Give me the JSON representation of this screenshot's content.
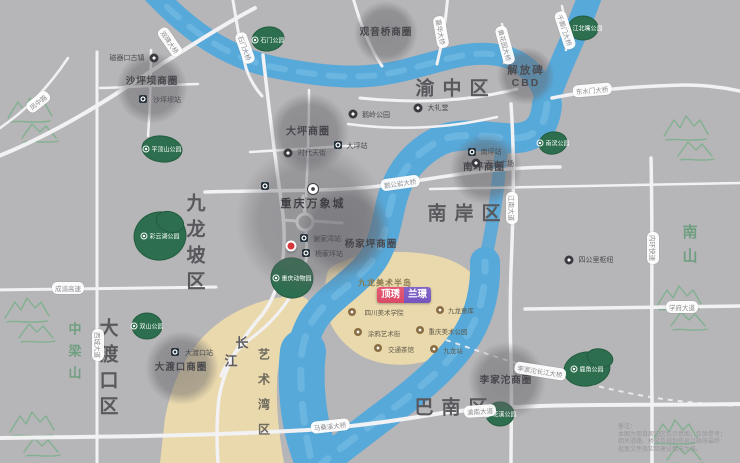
{
  "districts": {
    "yuzhong": "渝中区",
    "nanan": "南岸区",
    "banan": "巴南区",
    "jiulongpo": "九龙坡区",
    "dadukou": "大渡口区"
  },
  "mountains": {
    "zhongliangshan": "中梁山",
    "nanshan": "南山"
  },
  "river": {
    "changjiang_1": "长",
    "changjiang_2": "江",
    "art_bay": "艺术湾区",
    "peninsula": "九龙美术半岛"
  },
  "project": {
    "name_left": "顶琇",
    "name_right": "兰璟"
  },
  "business_circles": {
    "shapingba": "沙坪坝商圈",
    "guanyinqiao": "观音桥商圈",
    "daping": "大坪商圈",
    "jiefangbei_line1": "解放碑",
    "jiefangbei_line2": "CBD",
    "nanping": "南坪商圈",
    "yangjiaping": "杨家坪商圈",
    "dadukou": "大渡口商圈",
    "lijiatuo": "李家沱商圈"
  },
  "landmarks": {
    "mixc": "重庆万象城",
    "ciqikou": "磁器口古镇",
    "eling": "鹅岭公园",
    "dalitang": "大礼堂",
    "sigongli": "四公里枢纽",
    "scfai": "四川美术学院",
    "jiulongyiku": "九龙意库",
    "tuya": "涂鸦艺术街",
    "art_park": "重庆美术公园",
    "tea": "交通茶馆",
    "jiulong_station": "九龙站",
    "times": "时代天街",
    "wanda": "万达广场"
  },
  "metro": {
    "shapingba": "沙坪坝站",
    "daping": "大坪站",
    "nanping": "南坪站",
    "dadukou": "大渡口站",
    "xiejiawan": "谢家湾站",
    "yangjiaping": "杨家坪站"
  },
  "parks": {
    "shimen": "石门公园",
    "pingdingshan": "平顶山公园",
    "caiyunhu": "彩云湖公园",
    "shuangshan": "双山公园",
    "zoo": "重庆动物园",
    "jiangbeizui": "江北嘴公园",
    "nanbin": "南滨公园",
    "huaxi": "花溪公园",
    "lujiao": "鹿角公园"
  },
  "bridges": {
    "shuangbei": "双碑大桥",
    "shimen": "石门大桥",
    "jiahua": "嘉华大桥",
    "huanghuayuan": "黄花园大桥",
    "qiansimen": "千厮门大桥",
    "dongshuimen": "东水门大桥",
    "egongyan": "鹅公岩大桥",
    "masangxi": "马桑溪大桥",
    "lijiatuo": "李家沱长江大桥"
  },
  "roads": {
    "chengyu": "成渝高速",
    "fengzhong": "凤中路",
    "xicheng": "西城大道",
    "neihuan": "内环快速",
    "jiangnan": "江南大道",
    "yunan": "渝南大道",
    "xuefu": "学府大道"
  },
  "colors": {
    "land": "#b6b5b7",
    "river": "#57a9da",
    "river_light": "#7fc2e8",
    "sand": "#ead9ad",
    "park": "#2c6e4d",
    "road": "#f2f1f3",
    "project_left": "#d94a66",
    "project_right": "#7656bd",
    "marker_red": "#d5373c"
  },
  "note": {
    "l1": "备注：",
    "l2": "本图为项目周边区位示意图，仅供参考；",
    "l3": "相关道路、桥梁及规划信息以政府最终",
    "l4": "批复文件及实际建设情况为准。"
  }
}
